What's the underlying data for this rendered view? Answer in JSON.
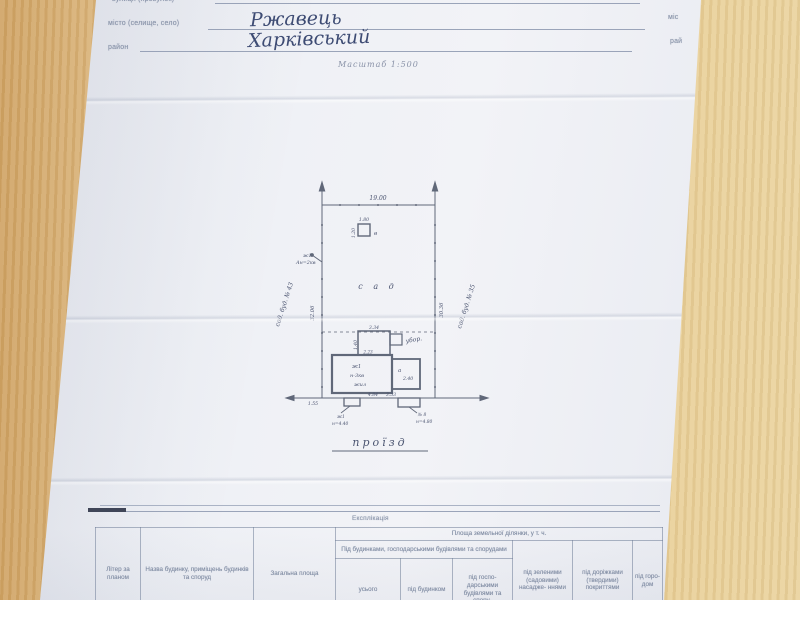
{
  "form": {
    "street_label": "вулиця (провулок)",
    "city_label": "місто (селище, село)",
    "city_value": "Ржавець",
    "district_label": "район",
    "district_value": "Харківський",
    "right_city": "міс",
    "right_district": "рай",
    "scale": "Масштаб 1:500"
  },
  "plan": {
    "top_dim": "19.00",
    "left_dim": "32.06",
    "right_dim": "30.36",
    "left_neighbor": "сад. буд. № 43",
    "right_neighbor": "сад. буд. № 35",
    "garden": "с а д",
    "well_w": "1.80",
    "well_h": "1.20",
    "well_letter": "в",
    "power_l1": "ж1",
    "power_l2": "Ан=2кв",
    "toilet": "убор.",
    "top_bld_dim": "3.34",
    "top_bld_side": "1.40",
    "top_bld_bottom": "2.23",
    "main_l1": "ж1",
    "main_l2": "н-3кв",
    "main_l3": "жил",
    "attach_letter": "а",
    "attach_dim": "2.40",
    "dim_left_bottom": "1.55",
    "dim_b1": "4.84",
    "dim_b2": "3.53",
    "stub_left_l1": "ж1",
    "stub_left_l2": "н=4.40",
    "stub_right_l1": "№ 8",
    "stub_right_l2": "н=4.80",
    "street": "проїзд"
  },
  "table": {
    "title": "Експлікація",
    "area_group": "Площа земельної ділянки, у т. ч.",
    "buildings_group": "Під будинками, господарськими будівлями та спорудами",
    "col_litera": "Літер за планом",
    "col_name": "Назва будинку, приміщень будинків та споруд",
    "col_total": "Загальна площа",
    "col_usogo": "усього",
    "col_under_house": "під будинком",
    "col_under_econ": "під госпо- дарськими будівлями та спору-",
    "col_green": "під зеленими (садовими) насадже- ннями",
    "col_paths": "під доріжками (твердими) покриттями",
    "col_garden": "під горо- дом"
  }
}
